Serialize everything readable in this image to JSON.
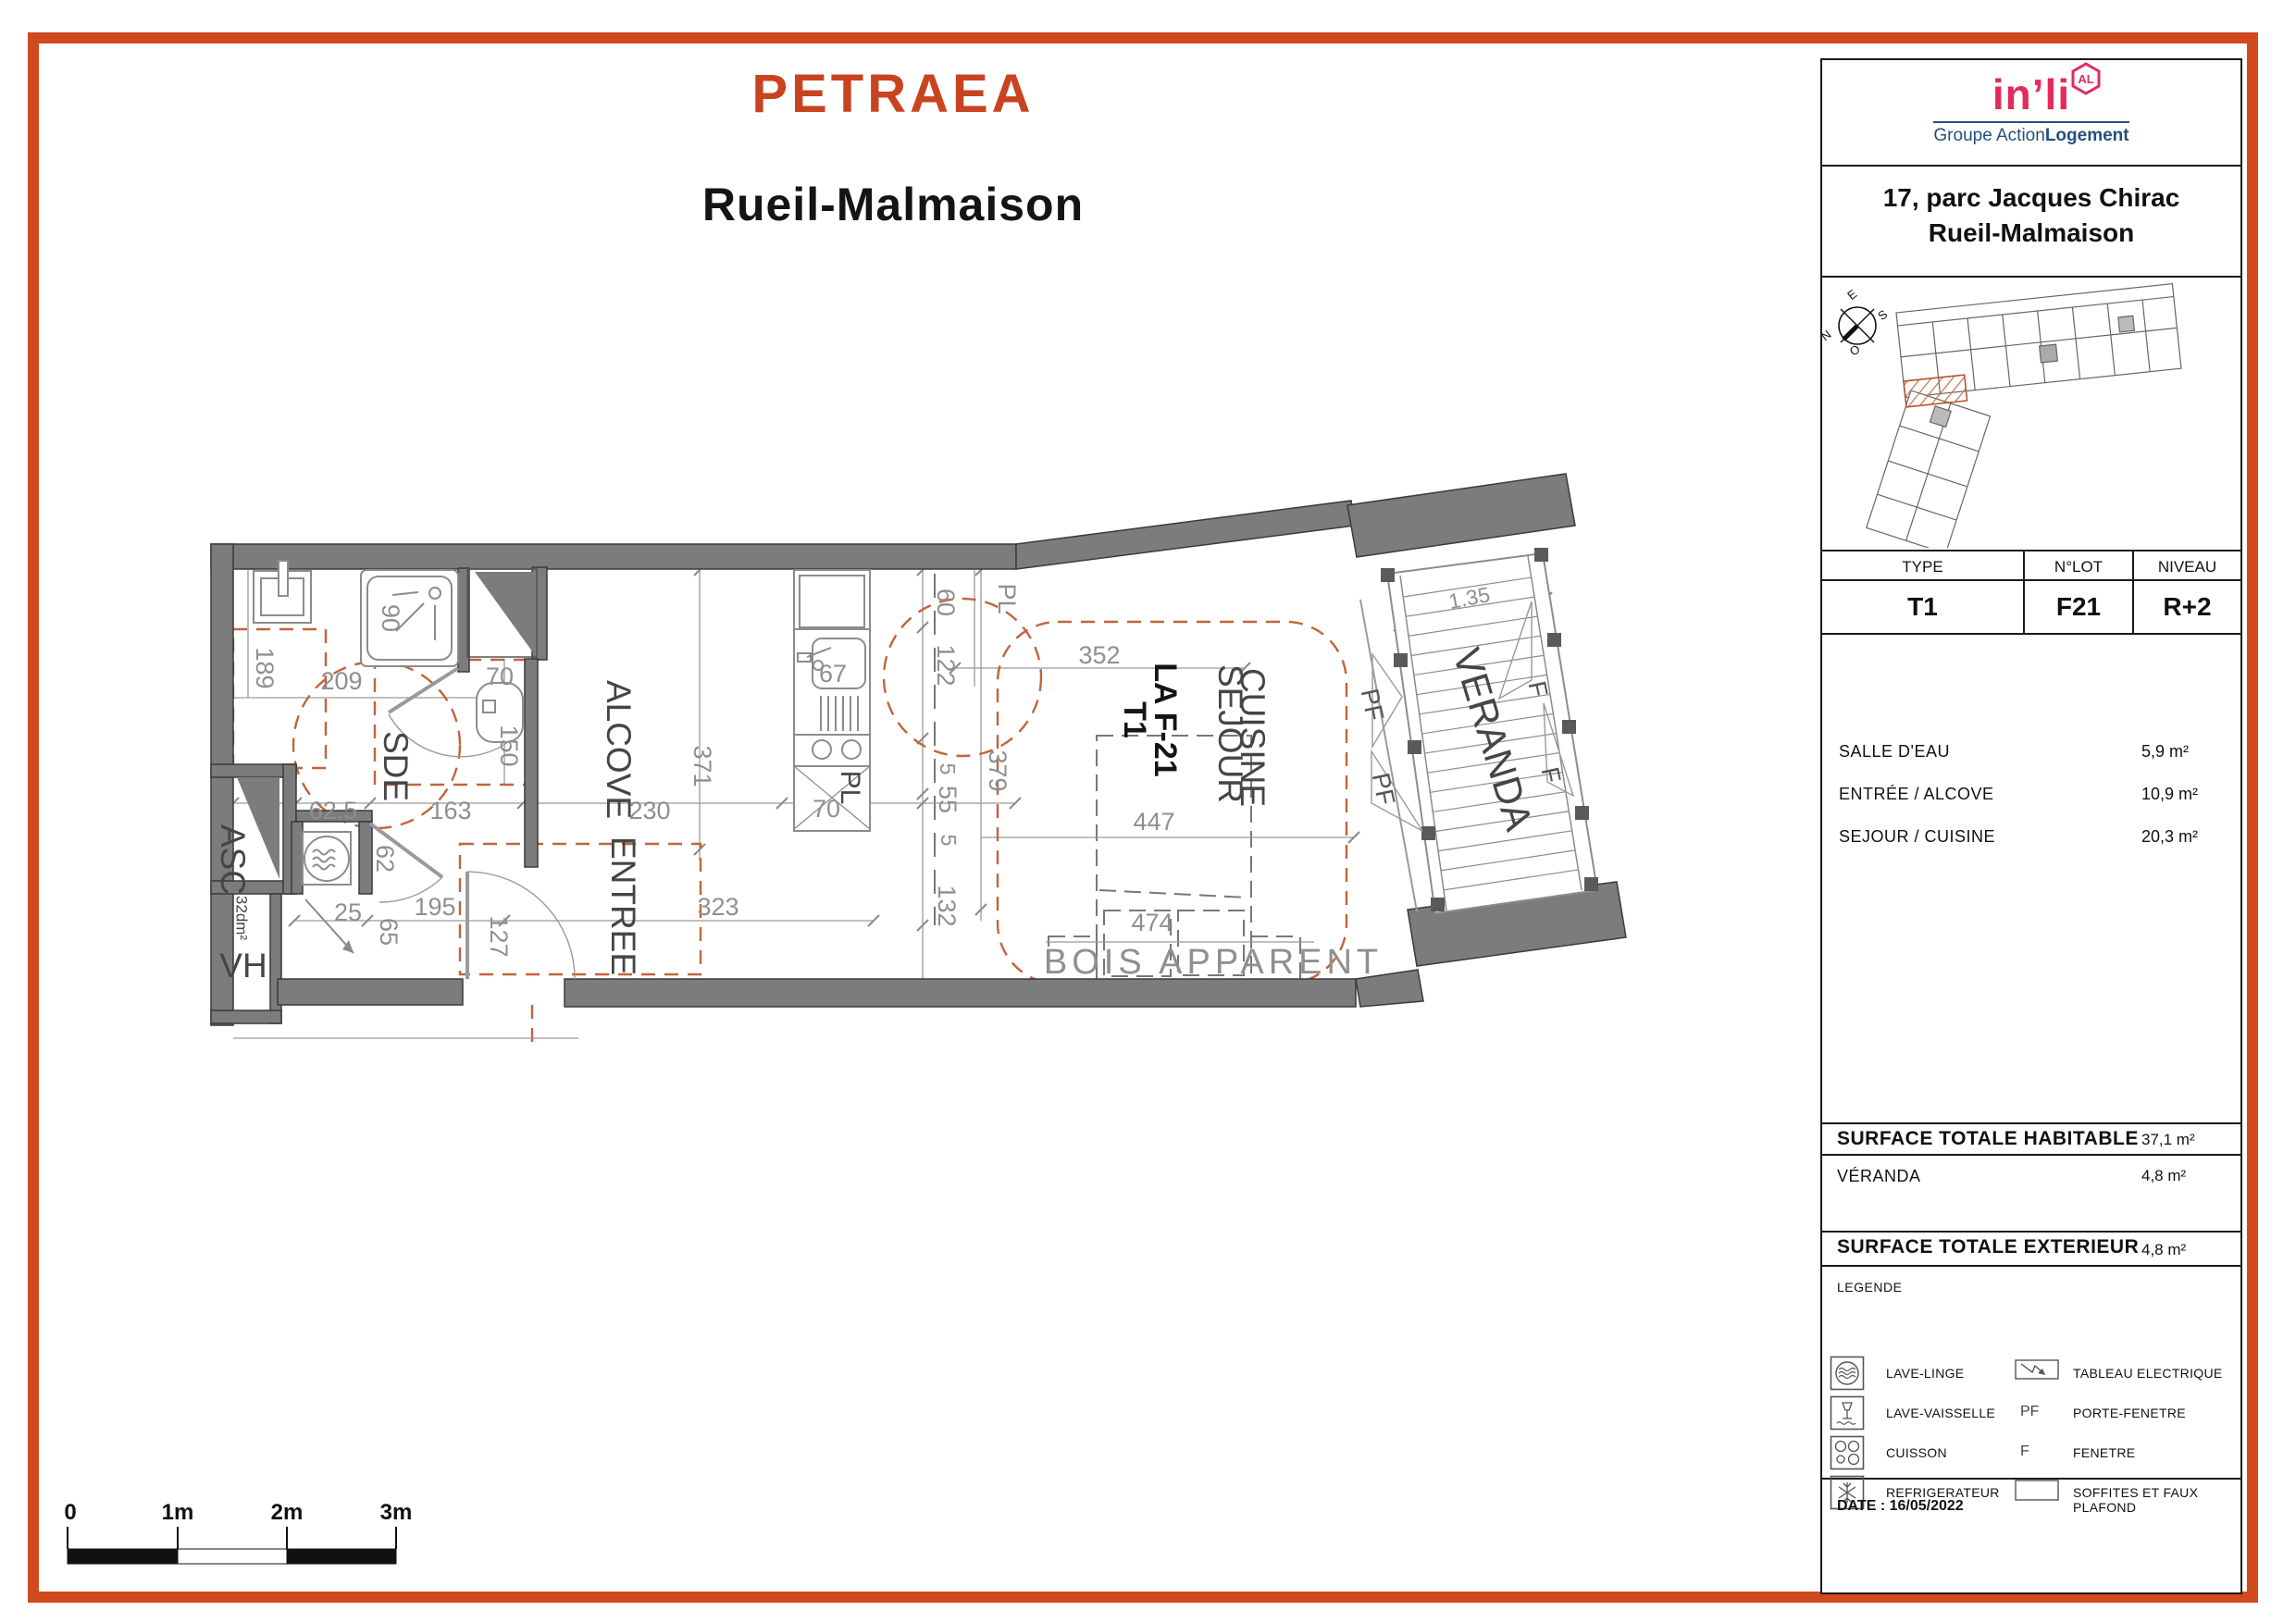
{
  "title": {
    "project": "PETRAEA",
    "city": "Rueil-Malmaison"
  },
  "sidebar": {
    "logo": {
      "brand": "in’li",
      "badge": "AL",
      "group_prefix": "Groupe Action",
      "group_suffix": "Logement"
    },
    "address": {
      "line1": "17, parc Jacques Chirac",
      "line2": "Rueil-Malmaison"
    },
    "compass": {
      "e": "E",
      "s": "S",
      "n": "N",
      "o": "O"
    },
    "unit_table": {
      "col1": "TYPE",
      "col2": "N°LOT",
      "col3": "NIVEAU",
      "val1": "T1",
      "val2": "F21",
      "val3": "R+2"
    },
    "rooms": [
      {
        "label": "SALLE D'EAU",
        "value": "5,9 m²"
      },
      {
        "label": "ENTRÉE / ALCOVE",
        "value": "10,9 m²"
      },
      {
        "label": "SEJOUR / CUISINE",
        "value": "20,3 m²"
      }
    ],
    "totals": {
      "habitable_label": "SURFACE TOTALE HABITABLE",
      "habitable_value": "37,1 m²",
      "veranda_label": "VÉRANDA",
      "veranda_value": "4,8 m²",
      "exterieur_label": "SURFACE TOTALE EXTERIEUR",
      "exterieur_value": "4,8 m²"
    },
    "legend": {
      "title": "LEGENDE",
      "items_left": [
        {
          "icon": "washing-machine",
          "label": "LAVE-LINGE"
        },
        {
          "icon": "dishwasher",
          "label": "LAVE-VAISSELLE"
        },
        {
          "icon": "cooktop",
          "label": "CUISSON"
        },
        {
          "icon": "snowflake",
          "label": "REFRIGERATEUR"
        }
      ],
      "items_right": [
        {
          "symbol": "",
          "label": "TABLEAU ELECTRIQUE"
        },
        {
          "symbol": "PF",
          "label": "PORTE-FENETRE"
        },
        {
          "symbol": "F",
          "label": "FENETRE"
        },
        {
          "symbol": "",
          "label": "SOFFITES ET FAUX PLAFOND"
        }
      ]
    },
    "date": "DATE : 16/05/2022"
  },
  "plan": {
    "rooms": {
      "sde": "SDE",
      "alcove": "ALCOVE",
      "entree": "ENTREE",
      "sejour": "SEJOUR",
      "cuisine": "CUISINE",
      "veranda": "VERANDA"
    },
    "unit": {
      "name": "LA F-21",
      "type": "T1"
    },
    "labels": {
      "asc": "ASC",
      "vh": "VH",
      "shaft_area": "32dm²",
      "pl_closet": "PL",
      "pl_small": "PL",
      "bois": "BOIS APPARENT",
      "pf1": "PF",
      "pf2": "PF",
      "f1": "F",
      "f2": "F"
    },
    "dims": {
      "d189": "189",
      "d209": "209",
      "d90": "90",
      "d70wc": "70",
      "d150": "150",
      "d62_5": "62.5",
      "d163": "163",
      "d230": "230",
      "d371": "371",
      "d62": "62",
      "d25": "25",
      "d65": "65",
      "d195": "195",
      "d127": "127",
      "d323": "323",
      "d67": "67",
      "d70pl": "70",
      "d60": "60",
      "d122": "122",
      "d5a": "5",
      "d55": "55",
      "d5b": "5",
      "d132": "132",
      "d379": "379",
      "d352": "352",
      "d447": "447",
      "d474": "474",
      "d135": "1.35"
    }
  },
  "scalebar": {
    "l0": "0",
    "l1": "1m",
    "l2": "2m",
    "l3": "3m"
  }
}
